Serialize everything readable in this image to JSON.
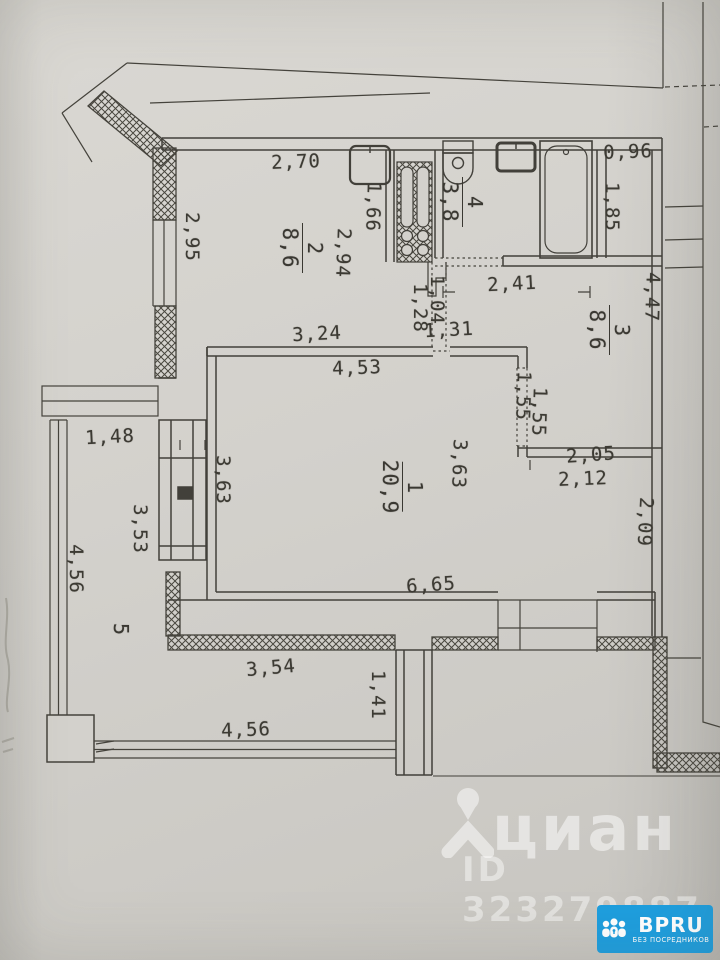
{
  "floorplan": {
    "rooms": [
      {
        "number": "1",
        "area": "20,9",
        "x": 402,
        "y": 487
      },
      {
        "number": "2",
        "area": "8,6",
        "x": 302,
        "y": 248
      },
      {
        "number": "3",
        "area": "8,6",
        "x": 609,
        "y": 330
      },
      {
        "number": "4",
        "area": "3,8",
        "x": 462,
        "y": 202
      },
      {
        "number": "5",
        "area": "",
        "x": 121,
        "y": 629
      }
    ],
    "dimensions": [
      {
        "text": "2,70",
        "orient": "h",
        "x": 296,
        "y": 162,
        "tilt": -2
      },
      {
        "text": "0,96",
        "orient": "h",
        "x": 628,
        "y": 152,
        "tilt": -2
      },
      {
        "text": "2,41",
        "orient": "h",
        "x": 512,
        "y": 284,
        "tilt": -3
      },
      {
        "text": "1,31",
        "orient": "h",
        "x": 449,
        "y": 330,
        "tilt": -3
      },
      {
        "text": "3,24",
        "orient": "h",
        "x": 317,
        "y": 334,
        "tilt": -3
      },
      {
        "text": "4,53",
        "orient": "h",
        "x": 357,
        "y": 368,
        "tilt": -2
      },
      {
        "text": "2,05",
        "orient": "h",
        "x": 591,
        "y": 455,
        "tilt": -4
      },
      {
        "text": "2,12",
        "orient": "h",
        "x": 583,
        "y": 479,
        "tilt": -2
      },
      {
        "text": "6,65",
        "orient": "h",
        "x": 431,
        "y": 585,
        "tilt": -4
      },
      {
        "text": "1,48",
        "orient": "h",
        "x": 110,
        "y": 437,
        "tilt": -3
      },
      {
        "text": "3,54",
        "orient": "h",
        "x": 271,
        "y": 668,
        "tilt": -5
      },
      {
        "text": "4,56",
        "orient": "h",
        "x": 246,
        "y": 730,
        "tilt": -2
      },
      {
        "text": "2,95",
        "orient": "v",
        "x": 192,
        "y": 237,
        "tilt": 0
      },
      {
        "text": "1,66",
        "orient": "v",
        "x": 373,
        "y": 207,
        "tilt": 2
      },
      {
        "text": "2,94",
        "orient": "v",
        "x": 343,
        "y": 253,
        "tilt": 2
      },
      {
        "text": "1,85",
        "orient": "v",
        "x": 612,
        "y": 207,
        "tilt": 0
      },
      {
        "text": "4,47",
        "orient": "v",
        "x": 652,
        "y": 297,
        "tilt": 2
      },
      {
        "text": "1,28",
        "orient": "v",
        "x": 420,
        "y": 308,
        "tilt": 0
      },
      {
        "text": "1,04",
        "orient": "v",
        "x": 437,
        "y": 300,
        "tilt": 0
      },
      {
        "text": "1,55",
        "orient": "v",
        "x": 523,
        "y": 396,
        "tilt": 2
      },
      {
        "text": "1,55",
        "orient": "v",
        "x": 539,
        "y": 412,
        "tilt": 2
      },
      {
        "text": "2,09",
        "orient": "v",
        "x": 645,
        "y": 522,
        "tilt": 3
      },
      {
        "text": "3,63",
        "orient": "v",
        "x": 223,
        "y": 480,
        "tilt": 0
      },
      {
        "text": "3,63",
        "orient": "v",
        "x": 459,
        "y": 464,
        "tilt": 2
      },
      {
        "text": "3,53",
        "orient": "v",
        "x": 140,
        "y": 529,
        "tilt": 0
      },
      {
        "text": "4,56",
        "orient": "v",
        "x": 76,
        "y": 569,
        "tilt": 0
      },
      {
        "text": "1,41",
        "orient": "v",
        "x": 378,
        "y": 695,
        "tilt": 0
      }
    ]
  },
  "watermark": {
    "brand": "циан",
    "listing_id": "ID 323279887"
  },
  "badge": {
    "brand": "BPRU",
    "tagline": "БЕЗ ПОСРЕДНИКОВ",
    "bg_color": "#1e9ede"
  },
  "icons": {
    "watermark_logo": "cian-person-pin-icon",
    "badge_logo": "people-group-icon"
  }
}
